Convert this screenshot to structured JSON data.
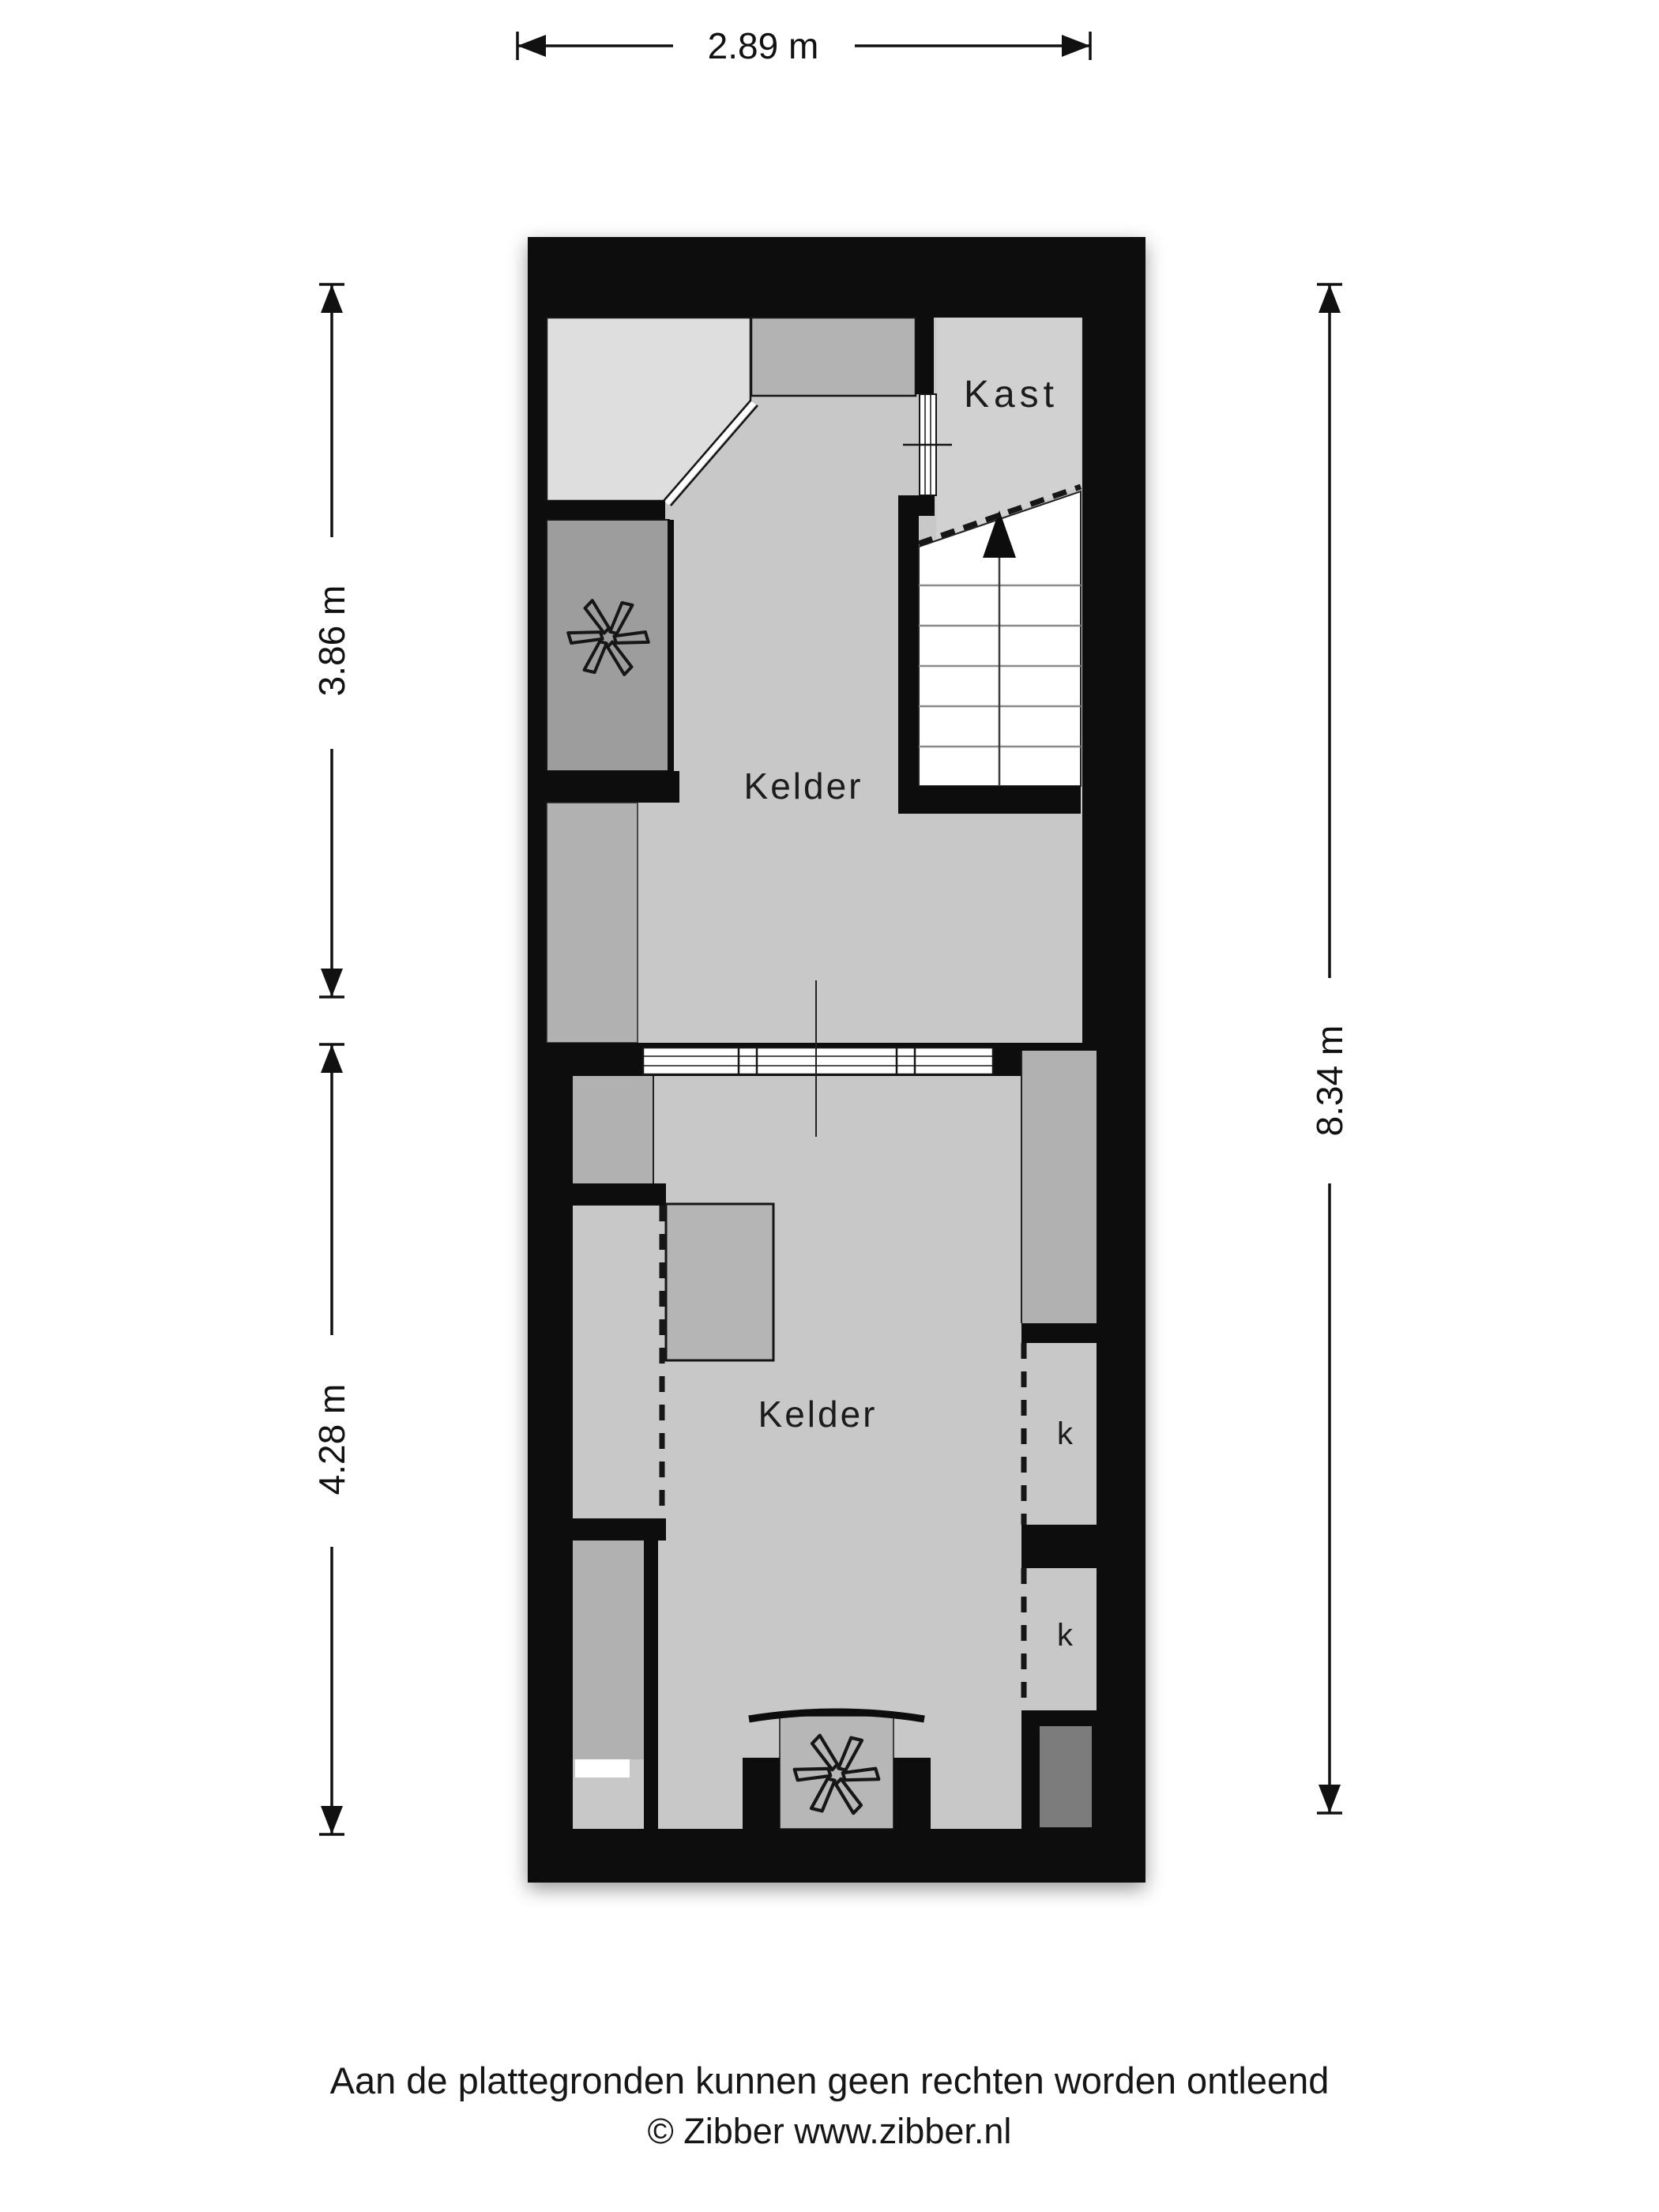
{
  "plan": {
    "rooms": {
      "kelder_upper": {
        "label": "Kelder"
      },
      "kelder_lower": {
        "label": "Kelder"
      },
      "kast": {
        "label": "Kast"
      },
      "closet_1": {
        "label": "k"
      },
      "closet_2": {
        "label": "k"
      }
    },
    "icons": {
      "fan_upper": "ventilation-fan-icon",
      "fan_lower": "ventilation-fan-icon",
      "stairs_up_arrow": "stairs-direction-up-arrow"
    },
    "colors": {
      "wall": "#0b0b0b",
      "floor": "#c8c8c8",
      "room_top_left": "#dedede",
      "room_top_center": "#b3b3b3",
      "kast_floor": "#d1d1d1",
      "fan_room": "#9d9d9d",
      "side_strip": "#b1b1b1",
      "object_block": "#b5b5b5",
      "niche_dark": "#7b7b7b",
      "fan_niche": "#b7b7b7",
      "stairs": "#ffffff"
    }
  },
  "dimensions": {
    "top": {
      "label": "2.89 m"
    },
    "left_upper": {
      "label": "3.86 m"
    },
    "left_lower": {
      "label": "4.28 m"
    },
    "right": {
      "label": "8.34 m"
    }
  },
  "footer": {
    "disclaimer": "Aan de plattegronden kunnen geen rechten worden ontleend",
    "copyright": "© Zibber www.zibber.nl"
  }
}
